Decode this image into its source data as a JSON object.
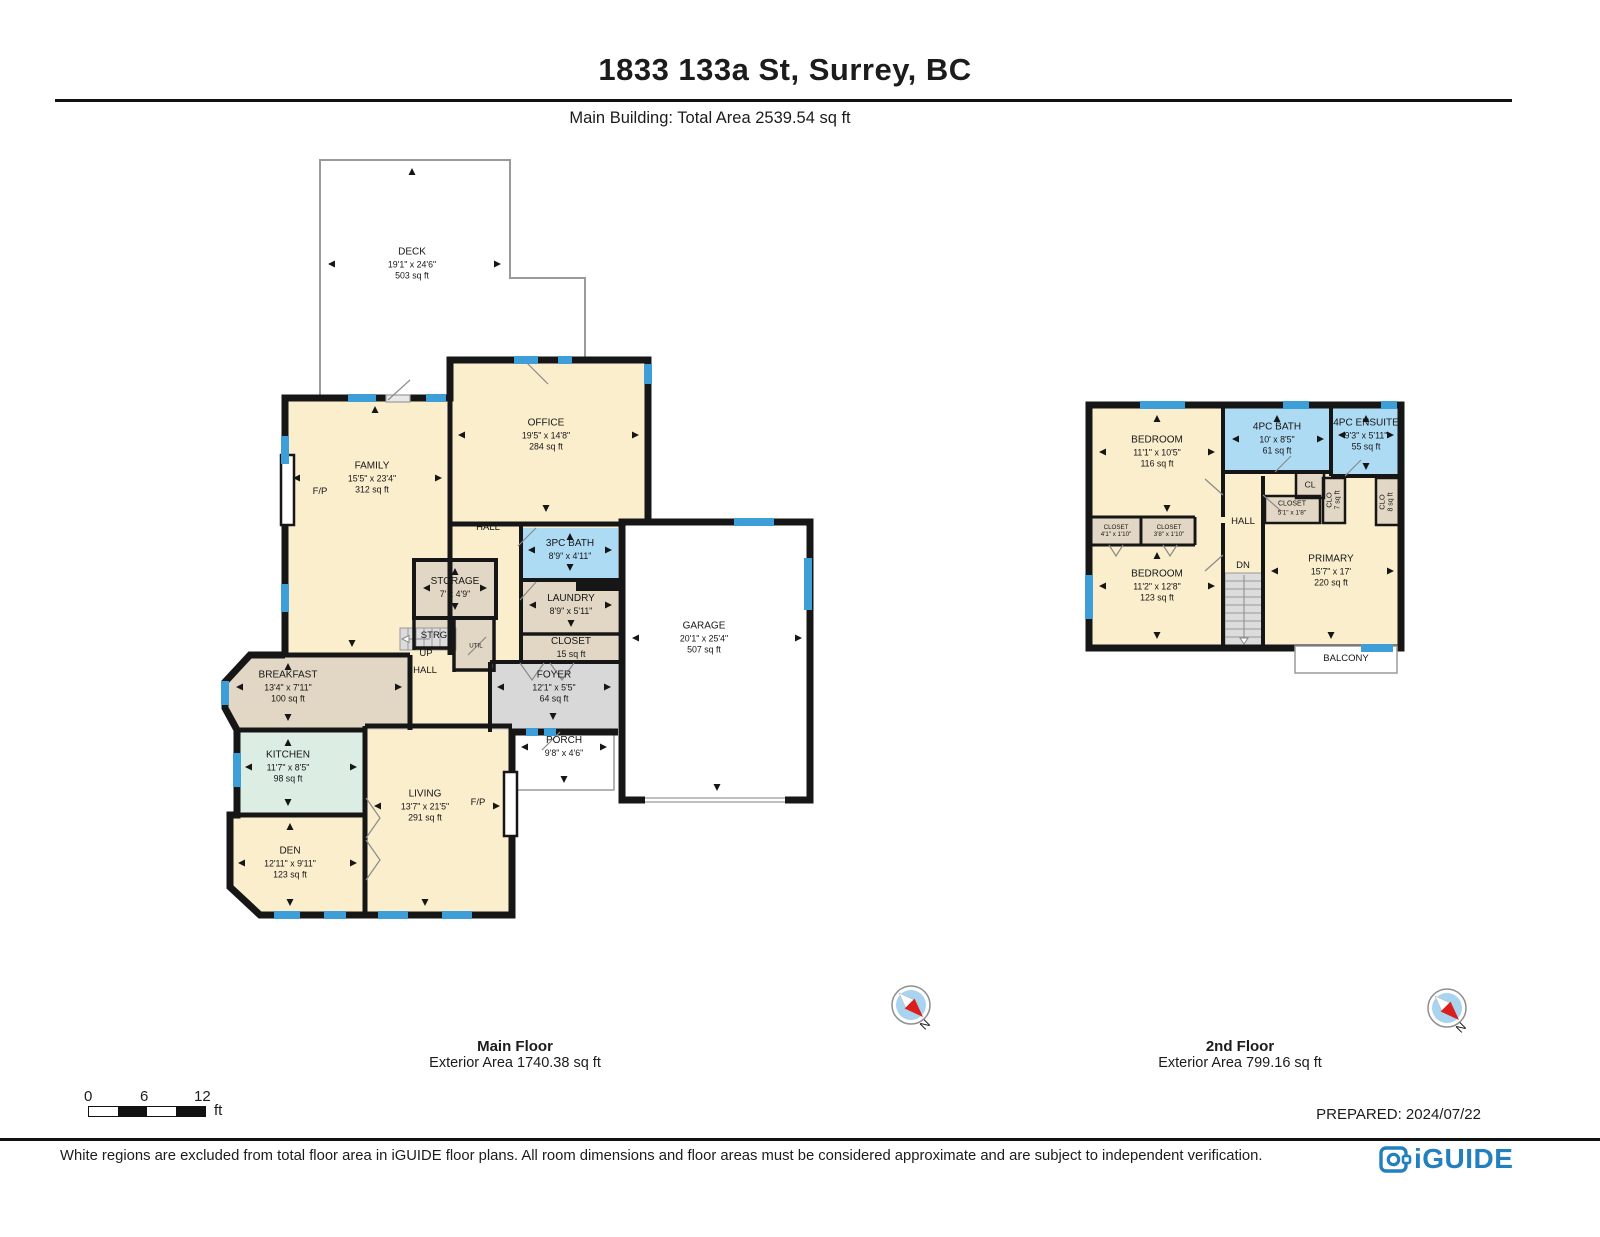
{
  "header": {
    "title": "1833 133a St, Surrey, BC",
    "subtitle": "Main Building: Total Area 2539.54 sq ft"
  },
  "main_floor": {
    "caption": "Main Floor",
    "caption_area": "Exterior Area 1740.38 sq ft",
    "rooms": {
      "deck": {
        "name": "DECK",
        "dims": "19'1\" x 24'6\"",
        "area": "503 sq ft"
      },
      "office": {
        "name": "OFFICE",
        "dims": "19'5\" x 14'8\"",
        "area": "284 sq ft"
      },
      "family": {
        "name": "FAMILY",
        "dims": "15'5\" x 23'4\"",
        "area": "312 sq ft"
      },
      "hall_upper": {
        "name": "HALL"
      },
      "bath3": {
        "name": "3PC BATH",
        "dims": "8'9\" x 4'11\""
      },
      "storage": {
        "name": "STORAGE",
        "dims": "7' x 4'9\""
      },
      "strg": {
        "name": "STRG"
      },
      "util": {
        "name": "UTIL"
      },
      "laundry": {
        "name": "LAUNDRY",
        "dims": "8'9\" x 5'11\""
      },
      "closet": {
        "name": "CLOSET",
        "area": "15 sq ft"
      },
      "foyer": {
        "name": "FOYER",
        "dims": "12'1\" x 5'5\"",
        "area": "64 sq ft"
      },
      "up": {
        "name": "UP"
      },
      "hall_lower": {
        "name": "HALL"
      },
      "breakfast": {
        "name": "BREAKFAST",
        "dims": "13'4\" x 7'11\"",
        "area": "100 sq ft"
      },
      "kitchen": {
        "name": "KITCHEN",
        "dims": "11'7\" x 8'5\"",
        "area": "98 sq ft"
      },
      "living": {
        "name": "LIVING",
        "dims": "13'7\" x 21'5\"",
        "area": "291 sq ft"
      },
      "den": {
        "name": "DEN",
        "dims": "12'11\" x 9'11\"",
        "area": "123 sq ft"
      },
      "porch": {
        "name": "PORCH",
        "dims": "9'8\" x 4'6\""
      },
      "garage": {
        "name": "GARAGE",
        "dims": "20'1\" x 25'4\"",
        "area": "507 sq ft"
      },
      "fireplace": {
        "name": "F/P"
      }
    }
  },
  "second_floor": {
    "caption": "2nd Floor",
    "caption_area": "Exterior Area 799.16 sq ft",
    "rooms": {
      "bedroom1": {
        "name": "BEDROOM",
        "dims": "11'1\" x 10'5\"",
        "area": "116 sq ft"
      },
      "bath4": {
        "name": "4PC BATH",
        "dims": "10' x 8'5\"",
        "area": "61 sq ft"
      },
      "ensuite": {
        "name": "4PC ENSUITE",
        "dims": "9'3\" x 5'11\"",
        "area": "55 sq ft"
      },
      "hall": {
        "name": "HALL"
      },
      "dn": {
        "name": "DN"
      },
      "cl": {
        "name": "CL"
      },
      "closet_c": {
        "name": "CLOSET",
        "dims": "5'1\" x 1'8\""
      },
      "clo7": {
        "name": "CLO",
        "area": "7 sq ft"
      },
      "clo8": {
        "name": "CLO",
        "area": "8 sq ft"
      },
      "closet_a": {
        "name": "CLOSET",
        "dims": "4'1\" x 1'10\""
      },
      "closet_b": {
        "name": "CLOSET",
        "dims": "3'8\" x 1'10\""
      },
      "bedroom2": {
        "name": "BEDROOM",
        "dims": "11'2\" x 12'8\"",
        "area": "123 sq ft"
      },
      "primary": {
        "name": "PRIMARY",
        "dims": "15'7\" x 17'",
        "area": "220 sq ft"
      },
      "balcony": {
        "name": "BALCONY"
      }
    }
  },
  "compass": {
    "north_label": "N"
  },
  "scalebar": {
    "tick0": "0",
    "tick1": "6",
    "tick2": "12",
    "unit": "ft"
  },
  "footer": {
    "prepared": "PREPARED: 2024/07/22",
    "disclaimer": "White regions are excluded from total floor area in iGUIDE floor plans. All room dimensions and floor areas must be considered approximate and are subject to independent verification.",
    "brand": "iGUIDE"
  },
  "colors": {
    "wall": "#161616",
    "window": "#3E9FD8",
    "room_cream": "#FAEECD",
    "room_tan": "#E2D7C4",
    "room_blue": "#AEDBF4",
    "room_teal": "#DCEDE4",
    "room_gray": "#D8D8D8",
    "brand_blue": "#2280BE"
  }
}
